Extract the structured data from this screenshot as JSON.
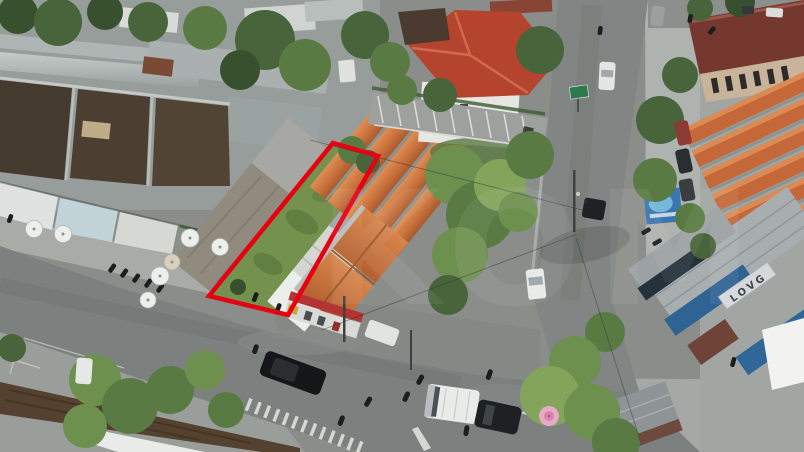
{
  "meta": {
    "description": "Aerial drone photo of a vacant grass land plot outlined in red beside an orange-tile-roofed building, at a street intersection with shops, trees and traffic",
    "width_px": 804,
    "height_px": 452
  },
  "plot": {
    "outline_color": "#e60012",
    "outline_width": "4.5",
    "surface": "grass"
  },
  "watermark": {
    "text": "KOM",
    "opacity": "0.06"
  },
  "signs": {
    "shop_awning_sign": "LOVG"
  },
  "palette": {
    "asphalt": "#7c807e",
    "grass": "#74914e",
    "orange_roof": "#c8713c",
    "maroon_roof": "#74382e",
    "metal_roof": "#b2b8b7",
    "rust_roof": "#54412f",
    "brown_roof": "#453a2e",
    "tree_dark": "#38502e",
    "tree_light": "#82a45b",
    "awning_blue": "#2e6394",
    "umbrella_pink": "#e9aac9",
    "canopy_white": "#f2f3f1"
  }
}
